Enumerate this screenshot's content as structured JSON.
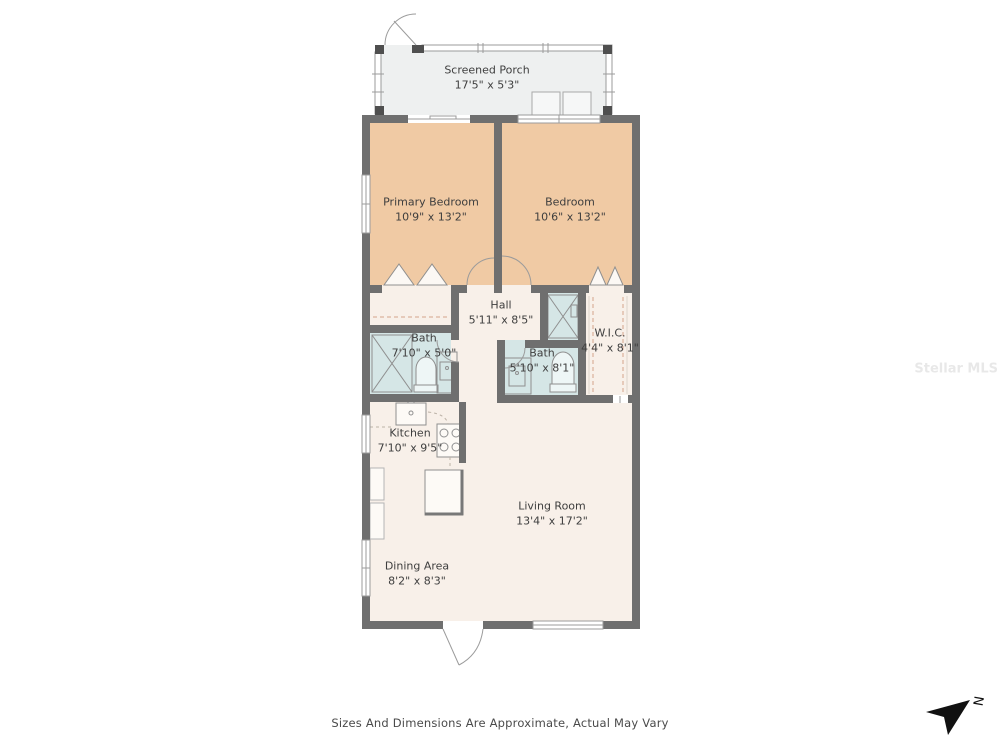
{
  "rooms": {
    "screened_porch": {
      "name": "Screened Porch",
      "dims": "17'5\" x 5'3\""
    },
    "primary_bedroom": {
      "name": "Primary Bedroom",
      "dims": "10'9\" x 13'2\""
    },
    "bedroom": {
      "name": "Bedroom",
      "dims": "10'6\" x 13'2\""
    },
    "hall": {
      "name": "Hall",
      "dims": "5'11\" x 8'5\""
    },
    "bath_main": {
      "name": "Bath",
      "dims": "7'10\" x 5'0\""
    },
    "wic": {
      "name": "W.I.C.",
      "dims": "4'4\" x 8'1\""
    },
    "bath_hall": {
      "name": "Bath",
      "dims": "5'10\" x 8'1\""
    },
    "kitchen": {
      "name": "Kitchen",
      "dims": "7'10\" x 9'5\""
    },
    "living_room": {
      "name": "Living Room",
      "dims": "13'4\" x 17'2\""
    },
    "dining_area": {
      "name": "Dining Area",
      "dims": "8'2\" x 8'3\""
    }
  },
  "footer": {
    "disclaimer": "Sizes And Dimensions Are Approximate, Actual May Vary"
  },
  "watermark": "Stellar MLS",
  "compass": {
    "label": "N"
  },
  "colors": {
    "bedroom_fill": "#f0caa4",
    "bath_fill": "#d5e6e6",
    "living_fill": "#f8f0e9",
    "porch_fill": "#eef0f0",
    "wall": "#6f6f6f",
    "closet_dash": "#d5a48c"
  }
}
